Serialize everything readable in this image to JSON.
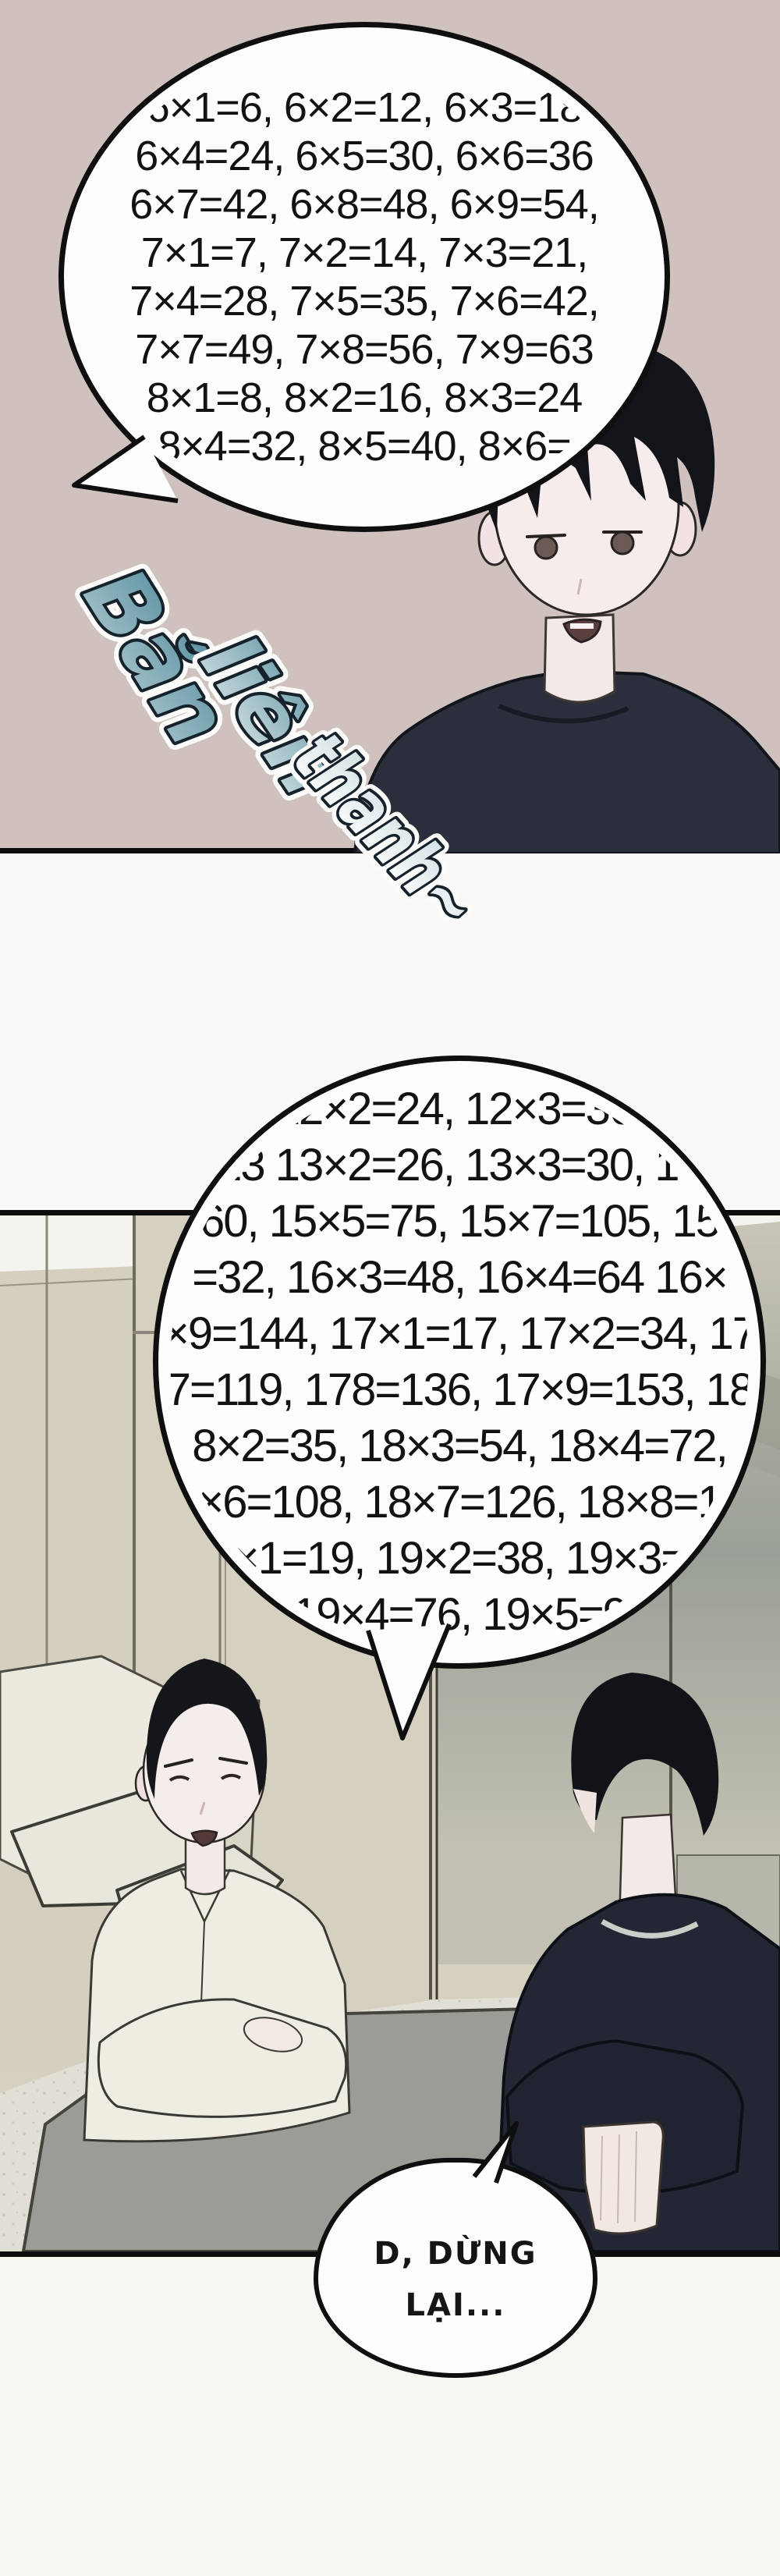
{
  "panel1": {
    "speech_bubble": {
      "lines": [
        "6×1=6, 6×2=12, 6×3=18",
        "6×4=24, 6×5=30, 6×6=36",
        "6×7=42, 6×8=48, 6×9=54,",
        "7×1=7, 7×2=14, 7×3=21,",
        "7×4=28, 7×5=35, 7×6=42,",
        "7×7=49, 7×8=56, 7×9=63",
        "8×1=8, 8×2=16, 8×3=24",
        "8×4=32, 8×5=40, 8×6="
      ]
    },
    "sfx": {
      "word1": "Bắn",
      "word2": "liên",
      "word3": "thanh~",
      "color": "#5f93a3"
    }
  },
  "panel2": {
    "speech_bubble": {
      "lines": [
        "12×2=24, 12×3=36,",
        "13 13×2=26, 13×3=30, 13",
        "60, 15×5=75, 15×7=105, 15",
        "=32, 16×3=48, 16×4=64 16×",
        "×9=144, 17×1=17, 17×2=34, 17",
        "7=119, 178=136, 17×9=153, 18",
        "8×2=35, 18×3=54, 18×4=72,",
        "×6=108, 18×7=126, 18×8=1",
        "×1=19, 19×2=38, 19×3=",
        "19×4=76, 19×5=9"
      ]
    },
    "small_speech_bubble": {
      "line1": "D, DỪNG",
      "line2": "LẠI..."
    }
  },
  "colors": {
    "panel1_bg": "#cfc1bd",
    "bubble_fill": "#fdfdfd",
    "ink": "#0f0f0f",
    "sfx_teal": "#5f93a3",
    "panel2_wall": "#d6d0c0",
    "mat_gray": "#9c9c96",
    "shirt_cream": "#efede2",
    "sweater_navy": "#232733"
  }
}
